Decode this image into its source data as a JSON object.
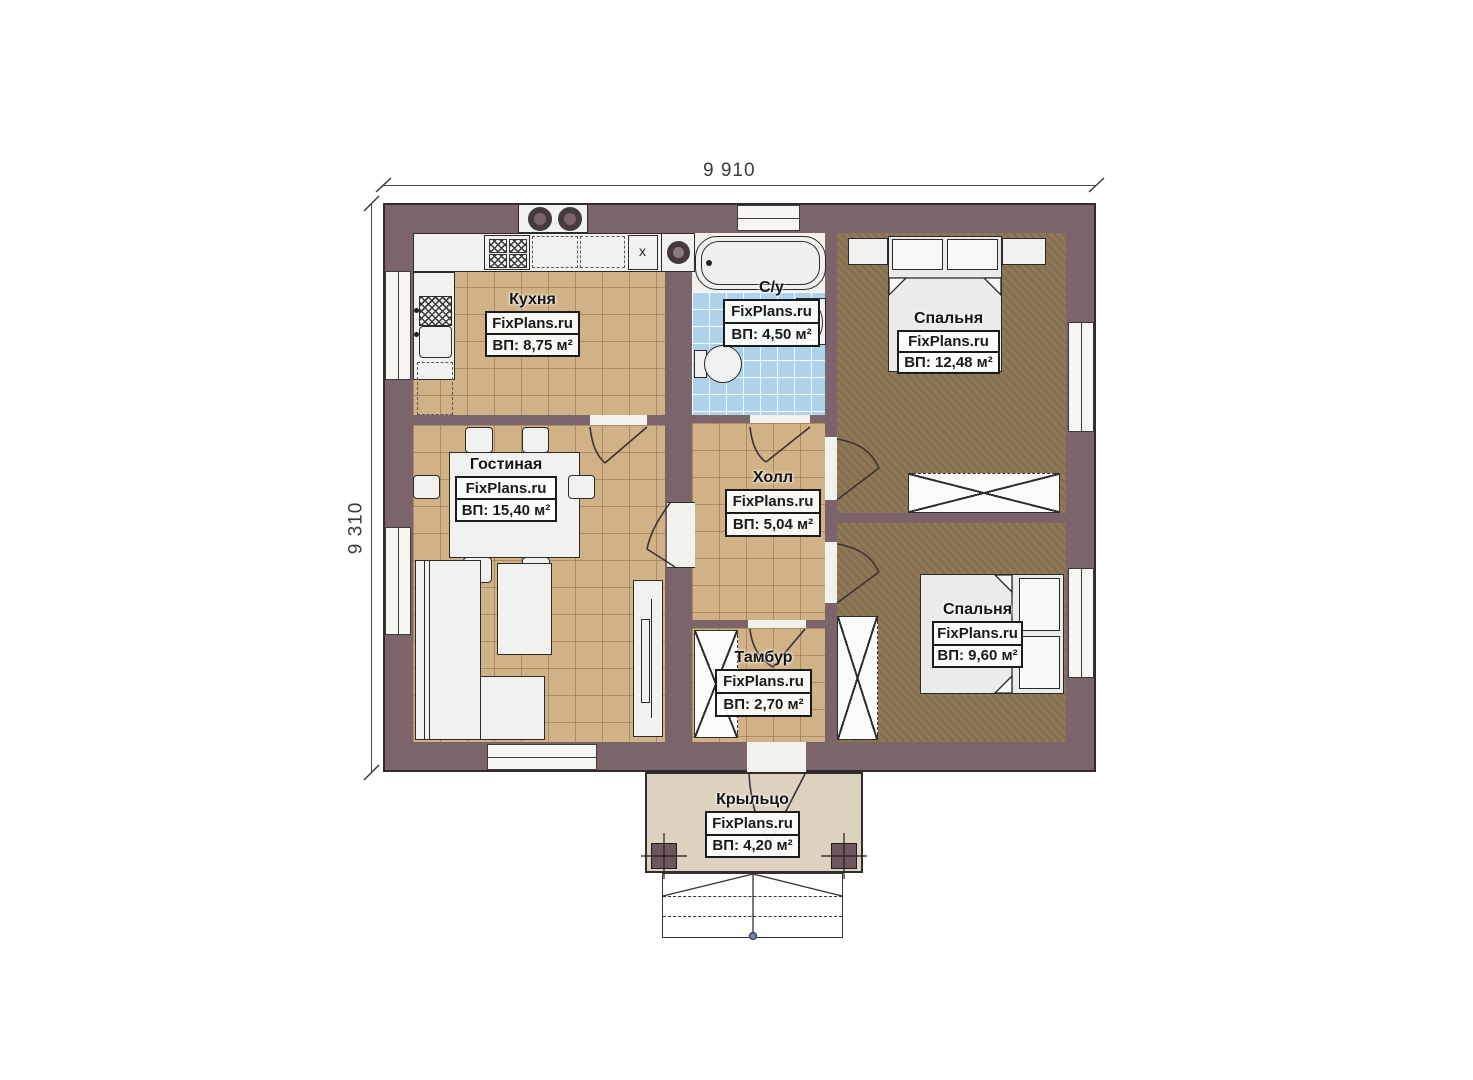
{
  "plan": {
    "source_watermark": "FixPlans.ru",
    "dimensions": {
      "top": "9 910",
      "left": "9 310"
    },
    "rooms": [
      {
        "id": "kitchen",
        "name": "Кухня",
        "area": "ВП: 8,75 м²"
      },
      {
        "id": "bathroom",
        "name": "С/у",
        "area": "ВП: 4,50 м²"
      },
      {
        "id": "bedroom1",
        "name": "Спальня",
        "area": "ВП: 12,48 м²"
      },
      {
        "id": "living",
        "name": "Гостиная",
        "area": "ВП: 15,40 м²"
      },
      {
        "id": "hall",
        "name": "Холл",
        "area": "ВП: 5,04 м²"
      },
      {
        "id": "tambur",
        "name": "Тамбур",
        "area": "ВП: 2,70 м²"
      },
      {
        "id": "bedroom2",
        "name": "Спальня",
        "area": "ВП: 9,60 м²"
      },
      {
        "id": "porch",
        "name": "Крыльцо",
        "area": "ВП: 4,20 м²"
      }
    ],
    "marks": {
      "kitchen_counter": "x"
    },
    "colors": {
      "wall": "#7b656a",
      "floor_tile_tan": "#d1b287",
      "floor_bedroom_dark": "#8a7453",
      "floor_bath_blue": "#aed2ec",
      "porch_fill": "#ddd1bf",
      "furniture": "#f1f1ef",
      "outline": "#332c2f"
    }
  }
}
